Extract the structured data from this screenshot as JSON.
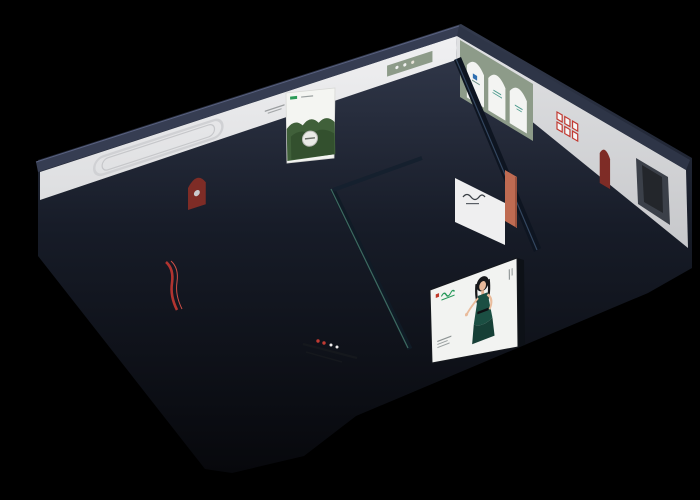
{
  "scene": {
    "background": "#000000",
    "kind": "isometric-3d-showroom-floorplan-render"
  },
  "palette": {
    "bg": "#000000",
    "floor": "#aeb0b2",
    "floorLight": "#c2c4c6",
    "floorDark": "#9c9ea0",
    "baseDark": "#0a0c12",
    "wallTop": "#363d52",
    "wallTopNE": "#2e3547",
    "wallFaceNW": "#ececee",
    "wallFaceNE": "#d9dadc",
    "wallBandDark": "#212839",
    "partition": "#e9e9eb",
    "glass": "#1a2436",
    "glassHighlight": "#3d6a60",
    "rug": "#c6c8ca",
    "rugBlue": "#bcd0e0",
    "sofaTeal": "#5a7473",
    "sofaBrown": "#a97a5a",
    "sofaCaramel": "#ad7c57",
    "sofaTaupe": "#b79b90",
    "sofaBlueLight": "#a4bad2",
    "sofaNavy": "#46637a",
    "sofaSlate": "#8b9097",
    "sofaWhite": "#ebebed",
    "sofaSalmon": "#c57862",
    "chairOrange": "#e08a28",
    "chairTerracotta": "#b4684f",
    "chairCream": "#d9d0c1",
    "chairMint": "#b7d4c6",
    "pillowYellow": "#f0a32c",
    "pillowWhite": "#f2f2f2",
    "pillowCream": "#e8e2d8",
    "accentRed": "#b23430",
    "nicheRed": "#7e2c26",
    "frameRed": "#c23b33",
    "greenWall": "#8d9b89",
    "plant": "#5d8049",
    "plantDark": "#32502c",
    "atriumFloor": "#3b5840",
    "black": "#141619",
    "marble": "#f0f0f1",
    "white": "#f4f5f2"
  },
  "rooms": [
    {
      "id": "room-a",
      "label": "teal sofa lounge"
    },
    {
      "id": "room-b",
      "label": "leather sofa display with forest poster"
    },
    {
      "id": "room-c",
      "label": "caramel sofa display with orange chairs"
    },
    {
      "id": "room-d",
      "label": "arched gallery corner room"
    },
    {
      "id": "room-e",
      "label": "white sofa lounge"
    },
    {
      "id": "room-f",
      "label": "mattress and bed display"
    },
    {
      "id": "center-lounge",
      "label": "taupe sectional lounge"
    },
    {
      "id": "atrium",
      "label": "glass cactus atrium"
    },
    {
      "id": "dining",
      "label": "black oval dining and bar set"
    },
    {
      "id": "kitchen",
      "label": "kitchen and media benches"
    },
    {
      "id": "salmon-nook",
      "label": "salmon sofa nook"
    },
    {
      "id": "console-room",
      "label": "console room with red ladder shelf"
    }
  ],
  "billboard": {
    "panel_color": "#f2f3f1",
    "figure": "hostess in dark green evening dress",
    "logo_color": "#27995a",
    "chip_color": "#c0392b"
  },
  "posters": {
    "forest_poster": {
      "background": "#f4f5f2",
      "foliage": "#40603a"
    },
    "arch_gallery": {
      "wall": "#8d9b89",
      "arch_fill": "#f3f4f2"
    }
  }
}
